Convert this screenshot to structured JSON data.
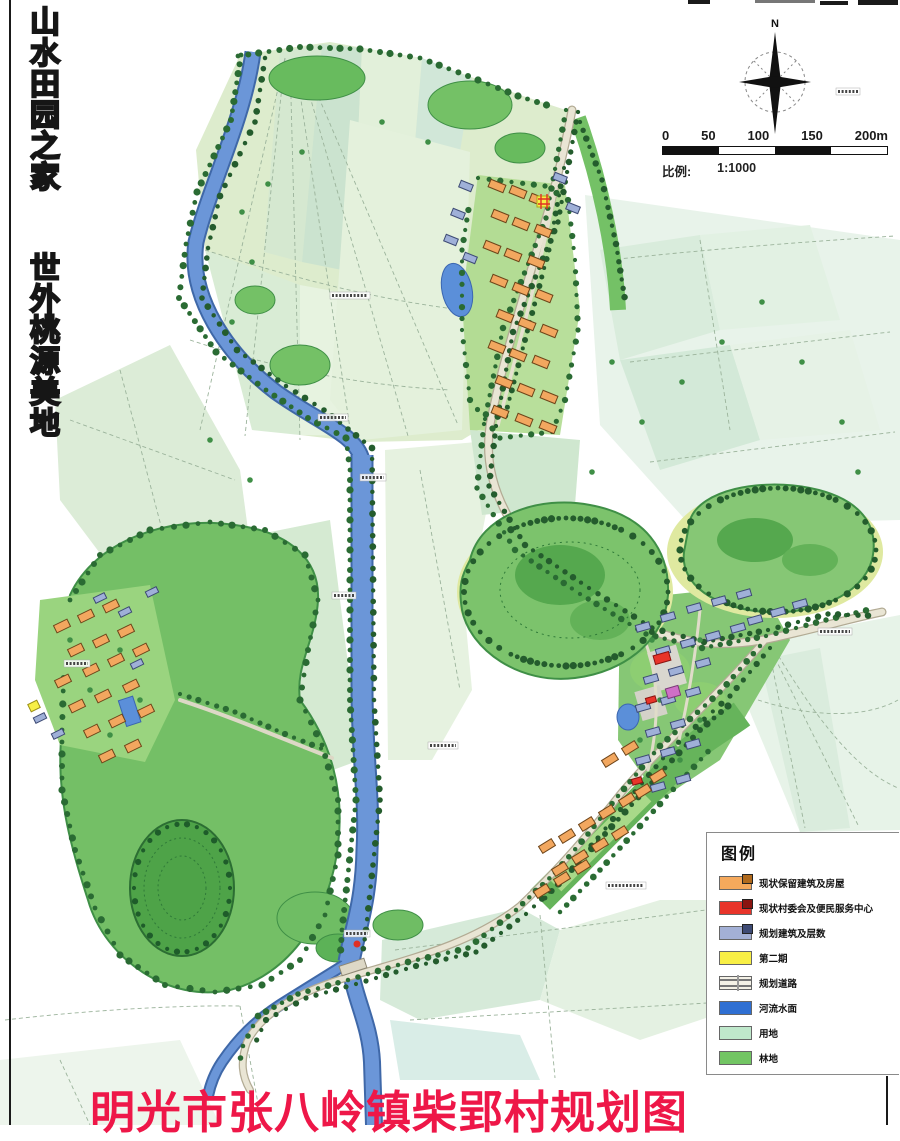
{
  "slogan": {
    "column1": "山水田园之家",
    "column2": "世外桃源美地"
  },
  "compass": {
    "north_label": "N"
  },
  "scale_bar": {
    "tick_labels": [
      "0",
      "50",
      "100",
      "150",
      "200m"
    ],
    "caption_label": "比例:",
    "caption_value": "1:1000"
  },
  "legend": {
    "title": "图例",
    "items": [
      {
        "id": "existing-building",
        "label": "现状保留建筑及房屋",
        "swatch": "building",
        "color": "#f5a95c",
        "stroke": "#b06a1d"
      },
      {
        "id": "village-committee",
        "label": "现状村委会及便民服务中心",
        "swatch": "building",
        "color": "#e8342a",
        "stroke": "#8a1410"
      },
      {
        "id": "planned-building",
        "label": "规划建筑及层数",
        "swatch": "building",
        "color": "#a3b0d6",
        "stroke": "#3d4a74"
      },
      {
        "id": "phase-two",
        "label": "第二期",
        "swatch": "plain",
        "color": "#f8ef45",
        "stroke": "#9a8f15"
      },
      {
        "id": "planned-road",
        "label": "规划道路",
        "swatch": "road",
        "color": "#f4f1e6",
        "stroke": "#8d8774"
      },
      {
        "id": "river-water",
        "label": "河流水面",
        "swatch": "plain",
        "color": "#2f6fd2",
        "stroke": "#1d4a9a"
      },
      {
        "id": "land",
        "label": "用地",
        "swatch": "plain",
        "color": "#bfe8cb",
        "stroke": "#7fae8b"
      },
      {
        "id": "forest",
        "label": "林地",
        "swatch": "plain",
        "color": "#72c563",
        "stroke": "#3c8a43"
      }
    ]
  },
  "title": {
    "text": "明光市张八岭镇柴郢村规划图",
    "color": "#ee1748"
  },
  "map_colors": {
    "field_light": "#ddeccd",
    "field_teal": "#d8efe7",
    "forest": "#7cc36c",
    "forest_dark": "#4ea348",
    "tree_dot": "#245c2d",
    "river": "#6b96d8",
    "road": "#e9e5d4",
    "building_existing": "#f2a75f",
    "building_planned": "#9fb0d8",
    "building_committee": "#e8342a",
    "building_special": "#f7ef45",
    "pond": "#5b8fd9"
  }
}
